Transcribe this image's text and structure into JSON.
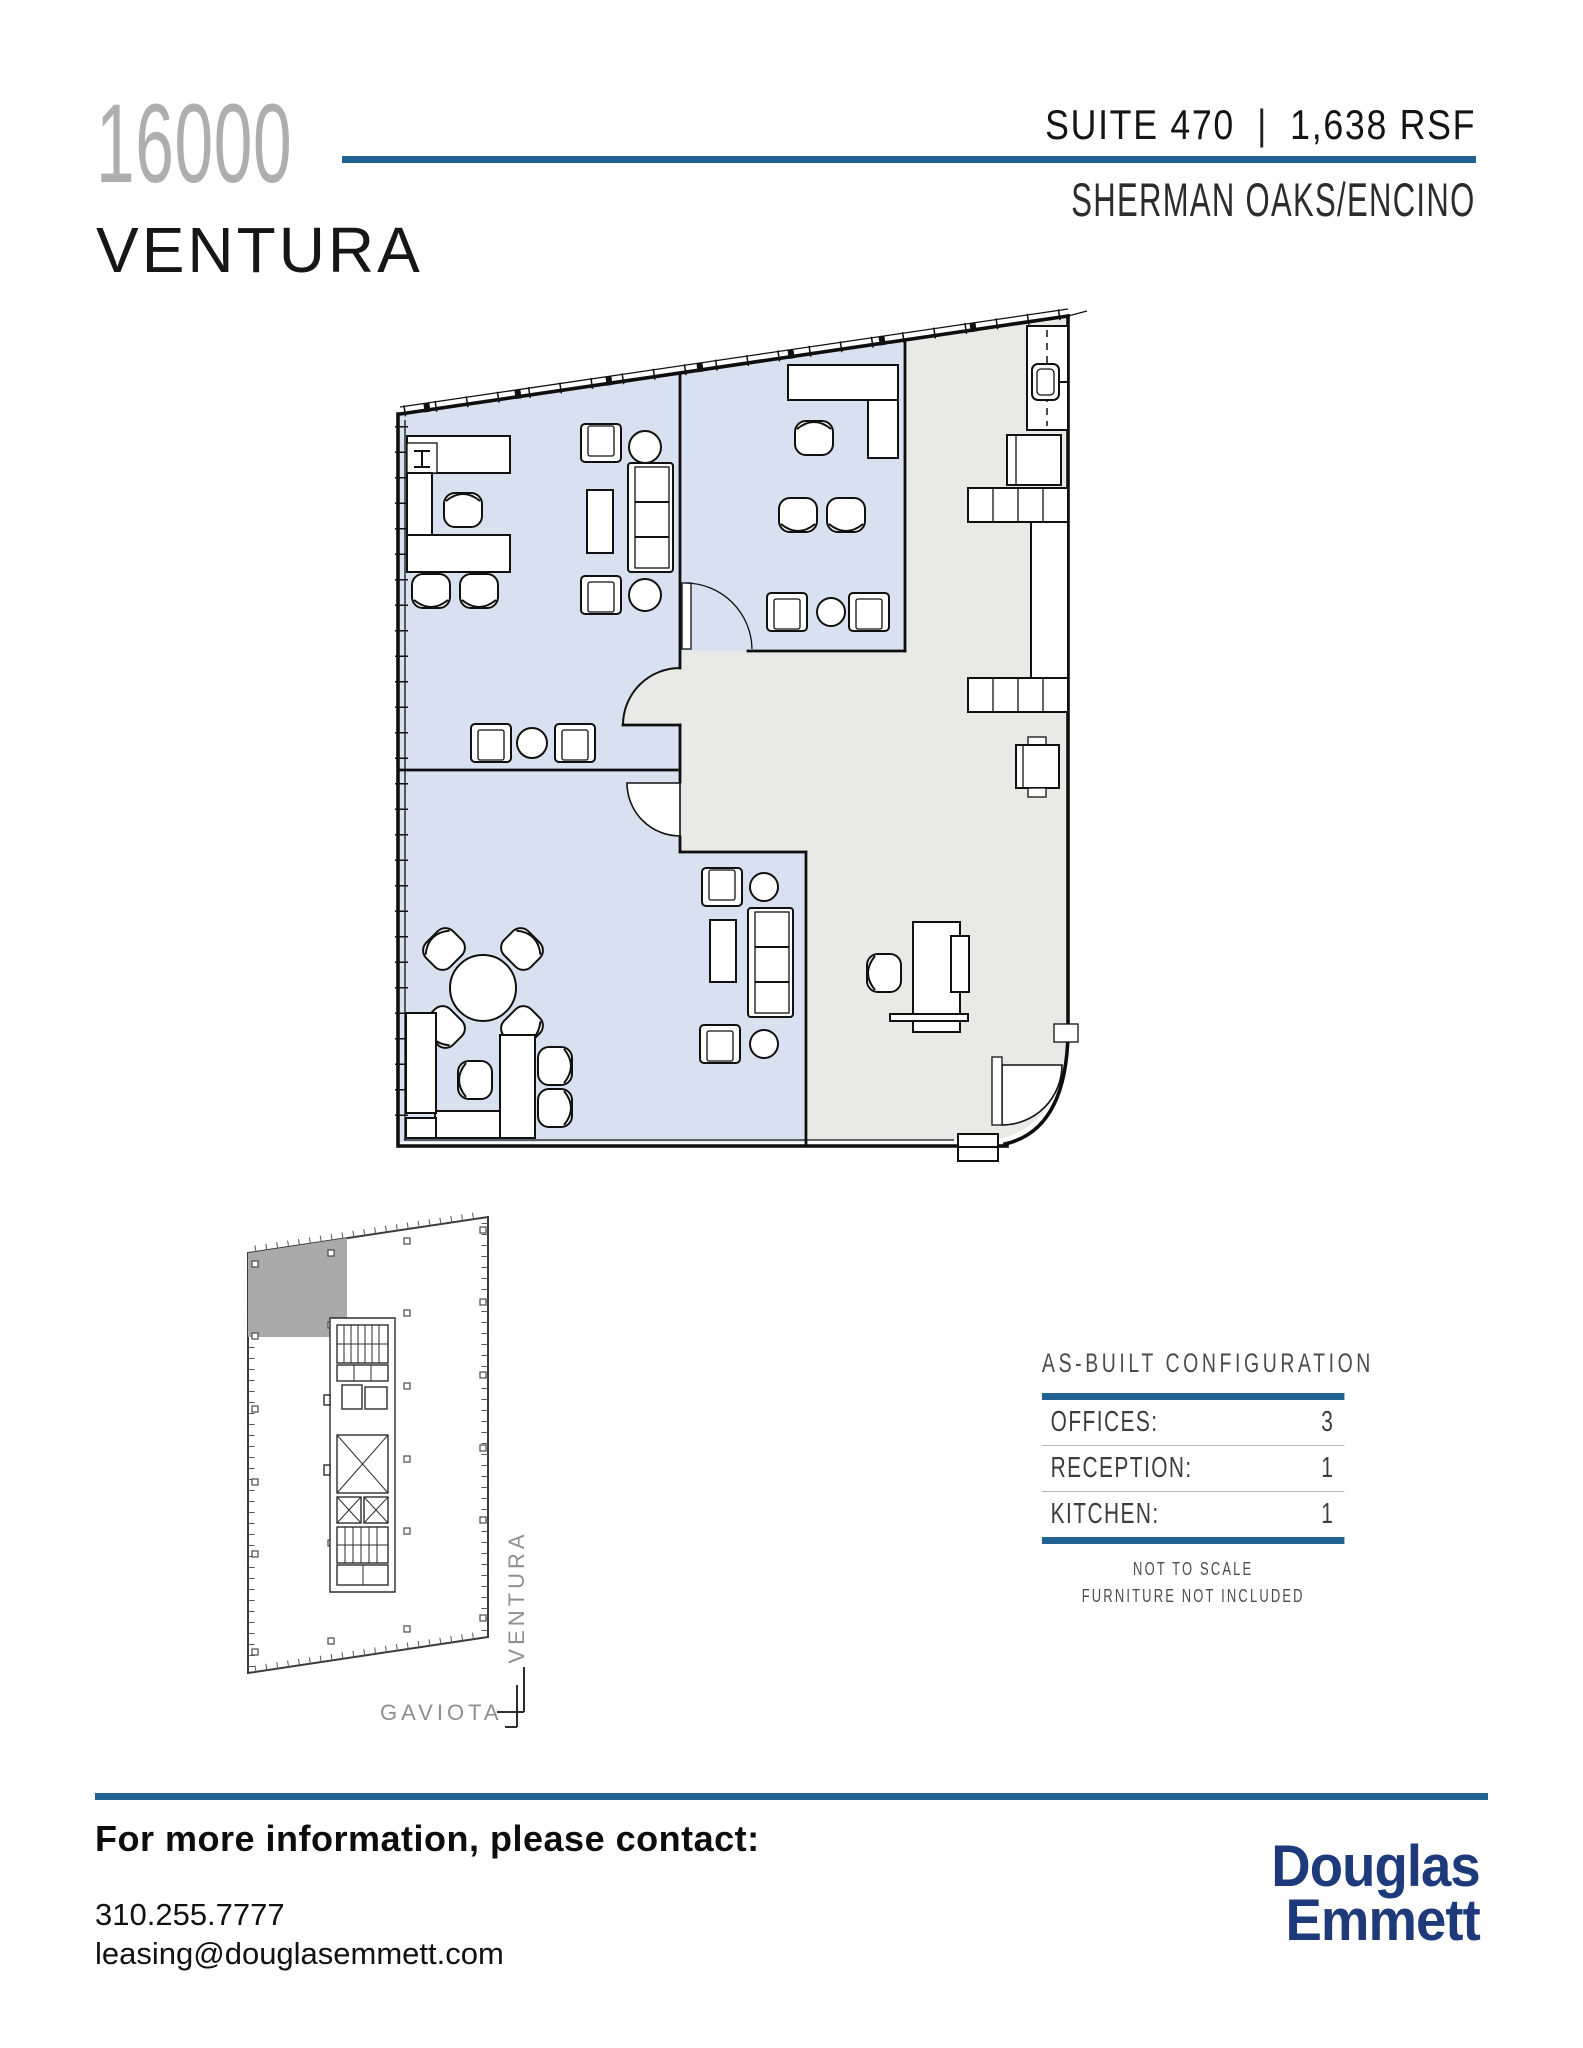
{
  "colors": {
    "accent": "#20618f",
    "room_blue": "#d8e1ef",
    "area_gray": "#e9e9e7",
    "suite_gray": "#a9a9a9",
    "navy": "#1e3a7a"
  },
  "header": {
    "building_number": "16000",
    "building_name": "VENTURA",
    "suite_label": "SUITE 470",
    "divider": "|",
    "size_label": "1,638 RSF",
    "submarket": "SHERMAN OAKS/ENCINO"
  },
  "site_plan": {
    "street_side": "VENTURA",
    "street_bottom": "GAVIOTA"
  },
  "as_built": {
    "title": "AS-BUILT CONFIGURATION",
    "rows": [
      {
        "label": "OFFICES:",
        "value": "3"
      },
      {
        "label": "RECEPTION:",
        "value": "1"
      },
      {
        "label": "KITCHEN:",
        "value": "1"
      }
    ],
    "notes": [
      "NOT TO SCALE",
      "FURNITURE NOT INCLUDED"
    ]
  },
  "footer": {
    "heading": "For more information, please contact:",
    "phone": "310.255.7777",
    "email": "leasing@douglasemmett.com",
    "brand_line1": "Douglas",
    "brand_line2": "Emmett"
  }
}
